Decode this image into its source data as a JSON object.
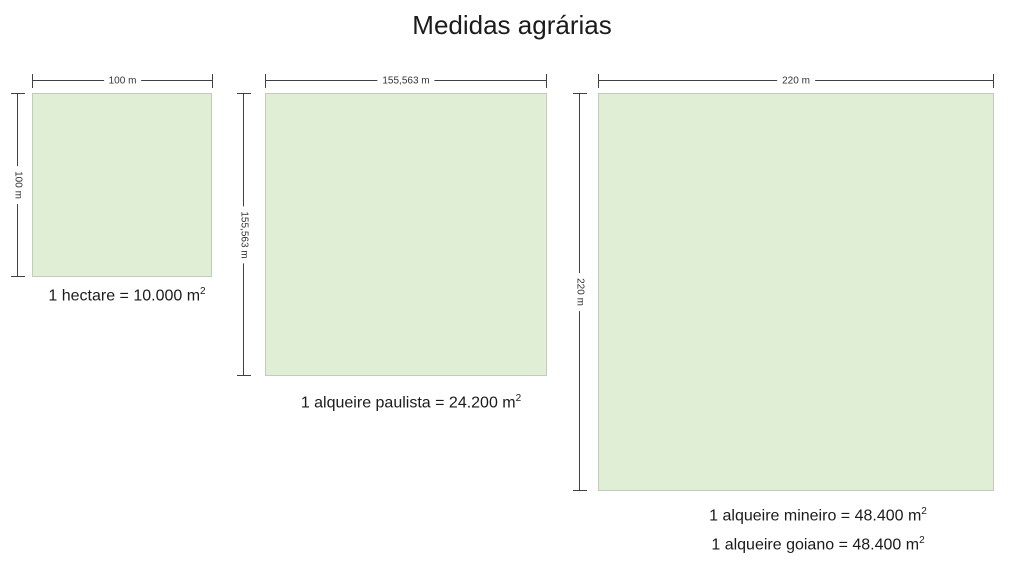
{
  "title": "Medidas agrárias",
  "colors": {
    "square_fill": "#e0eed6",
    "square_border": "#c3ccba",
    "dim_line": "#404040",
    "dim_text": "#333333",
    "caption_text": "#1b1b1b",
    "background": "#ffffff"
  },
  "figures": [
    {
      "name": "hectare",
      "width_label": "100 m",
      "height_label": "100 m",
      "caption": "1 hectare = 10.000 m",
      "caption_sup": "2"
    },
    {
      "name": "alqueire-paulista",
      "width_label": "155,563 m",
      "height_label": "155,563 m",
      "caption": "1 alqueire paulista = 24.200 m",
      "caption_sup": "2"
    },
    {
      "name": "alqueire-mineiro-goiano",
      "width_label": "220 m",
      "height_label": "220 m",
      "captions": [
        {
          "text": "1 alqueire mineiro = 48.400 m",
          "sup": "2"
        },
        {
          "text": "1 alqueire goiano = 48.400 m",
          "sup": "2"
        }
      ]
    }
  ]
}
